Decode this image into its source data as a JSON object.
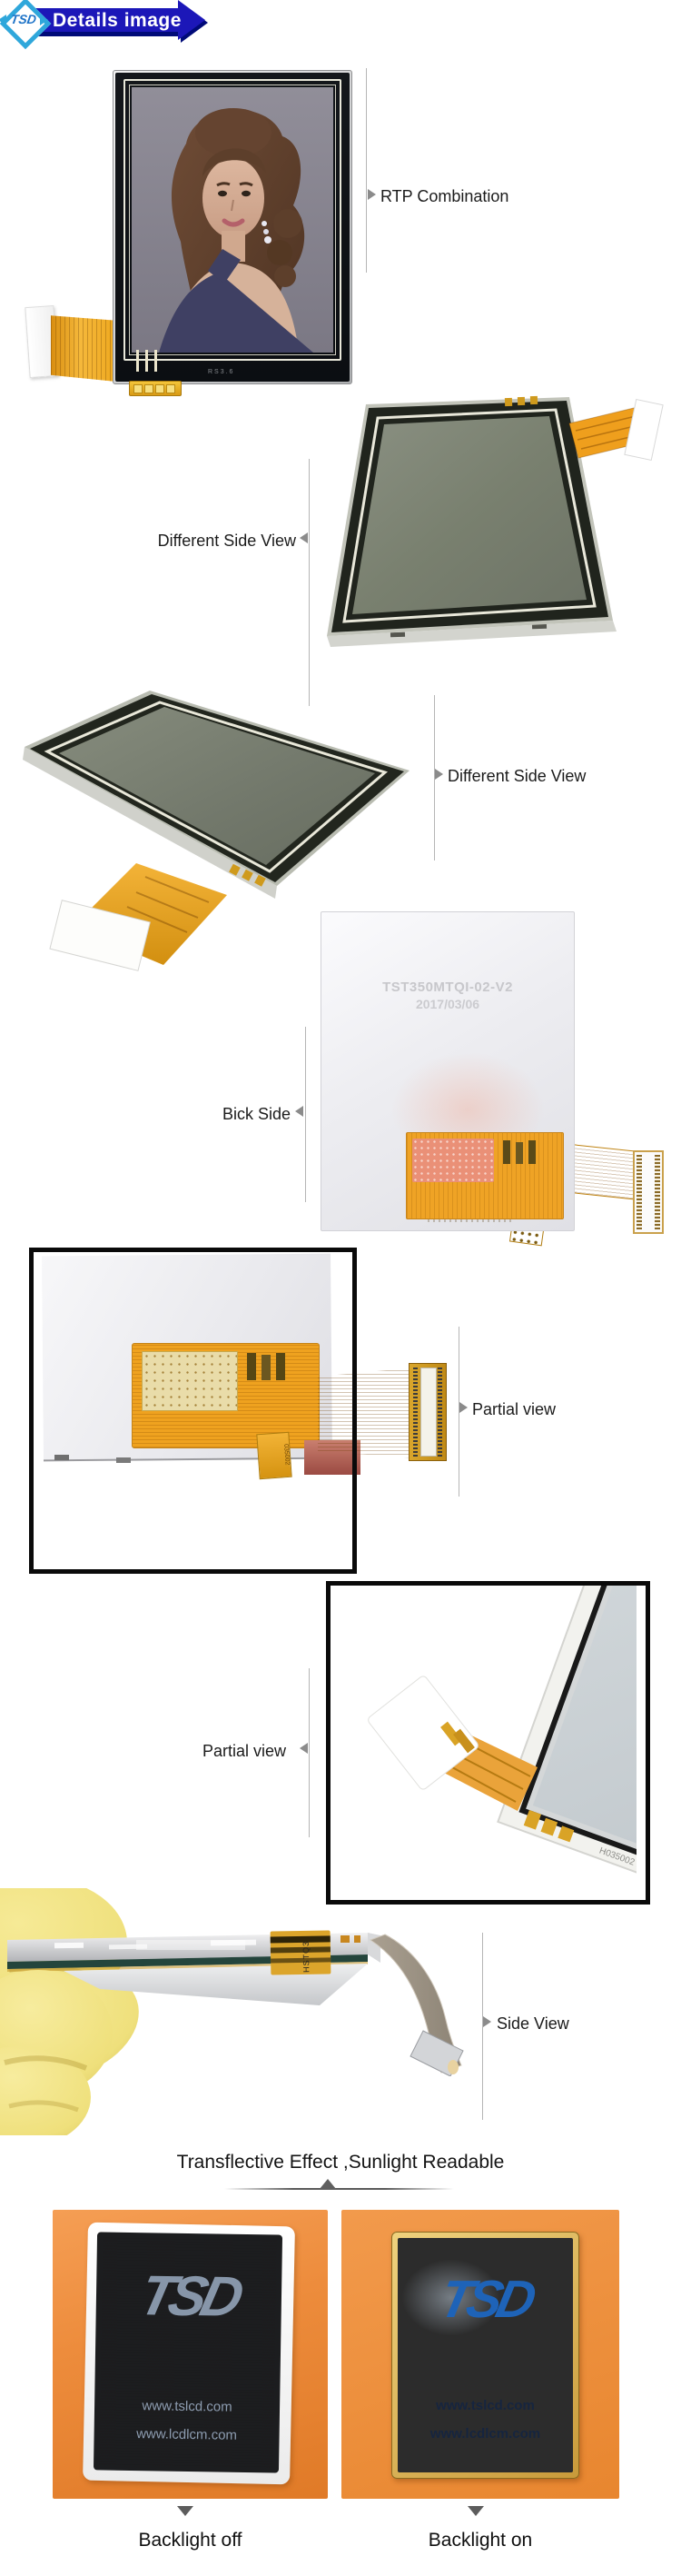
{
  "banner": {
    "logo_text": "TSD",
    "title": "Details image"
  },
  "annotations": {
    "rtp_combination": "RTP Combination",
    "different_side_view_1": "Different Side View",
    "different_side_view_2": "Different Side View",
    "bick_side": "Bick Side",
    "partial_view_1": "Partial view",
    "partial_view_2": "Partial view",
    "side_view": "Side View"
  },
  "back_panel": {
    "model_number": "TST350MTQI-02-V2",
    "date": "2017/03/06"
  },
  "markings": {
    "front_bottom_code": "RS3.6",
    "flex_tail_code": "035002",
    "glass_corner_code": "H035002 1-2",
    "kapton_code": "HSTQ3"
  },
  "heading": "Transflective Effect ,Sunlight Readable",
  "comparison": {
    "left_caption": "Backlight off",
    "right_caption": "Backlight on",
    "screen_logo": "TSD",
    "url_line1": "www.tslcd.com",
    "url_line2": "www.lcdlcm.com"
  },
  "colors": {
    "banner_blue": "#1C17B8",
    "logo_light_blue": "#2FA7DB",
    "logo_text_blue": "#1F74C8",
    "frame_orange": "#ED8C3C",
    "flex_orange": "#EFA21F",
    "screen_logo_blue": "#1E63B8"
  }
}
